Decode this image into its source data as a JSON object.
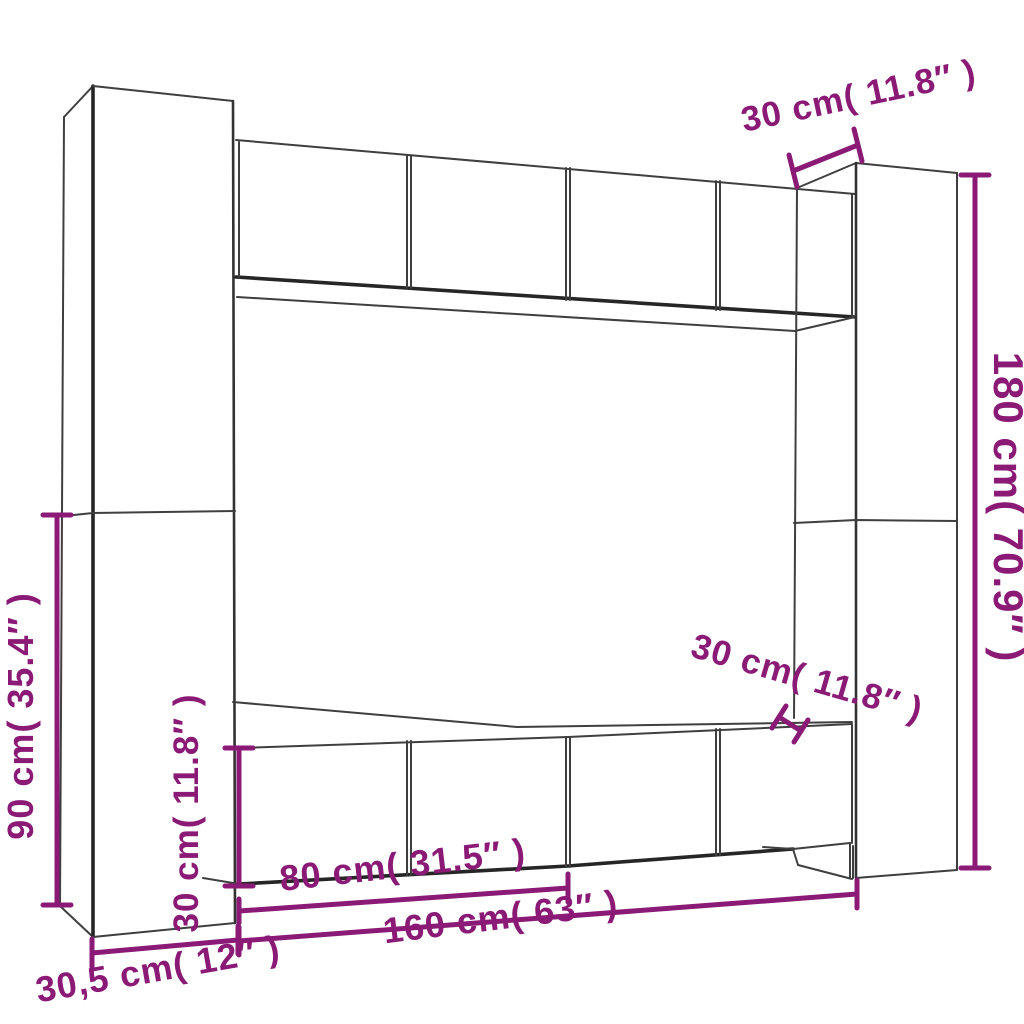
{
  "diagram": {
    "kind": "furniture-dimension-line-drawing",
    "accent_color": "#8a1a75",
    "line_color": "#3f3f3f",
    "background_color": "#ffffff",
    "labels": {
      "depth_top": "30 cm( 11.8″ )",
      "height_right": "180 cm( 70.9″ )",
      "height_left": "90 cm( 35.4″ )",
      "height_bottom_row": "30 cm( 11.8″ )",
      "depth_right": "30 cm( 11.8″ )",
      "width_80": "80 cm( 31.5″ )",
      "width_160": "160 cm( 63″ )",
      "width_30_5": "30,5 cm( 12″ )"
    }
  }
}
